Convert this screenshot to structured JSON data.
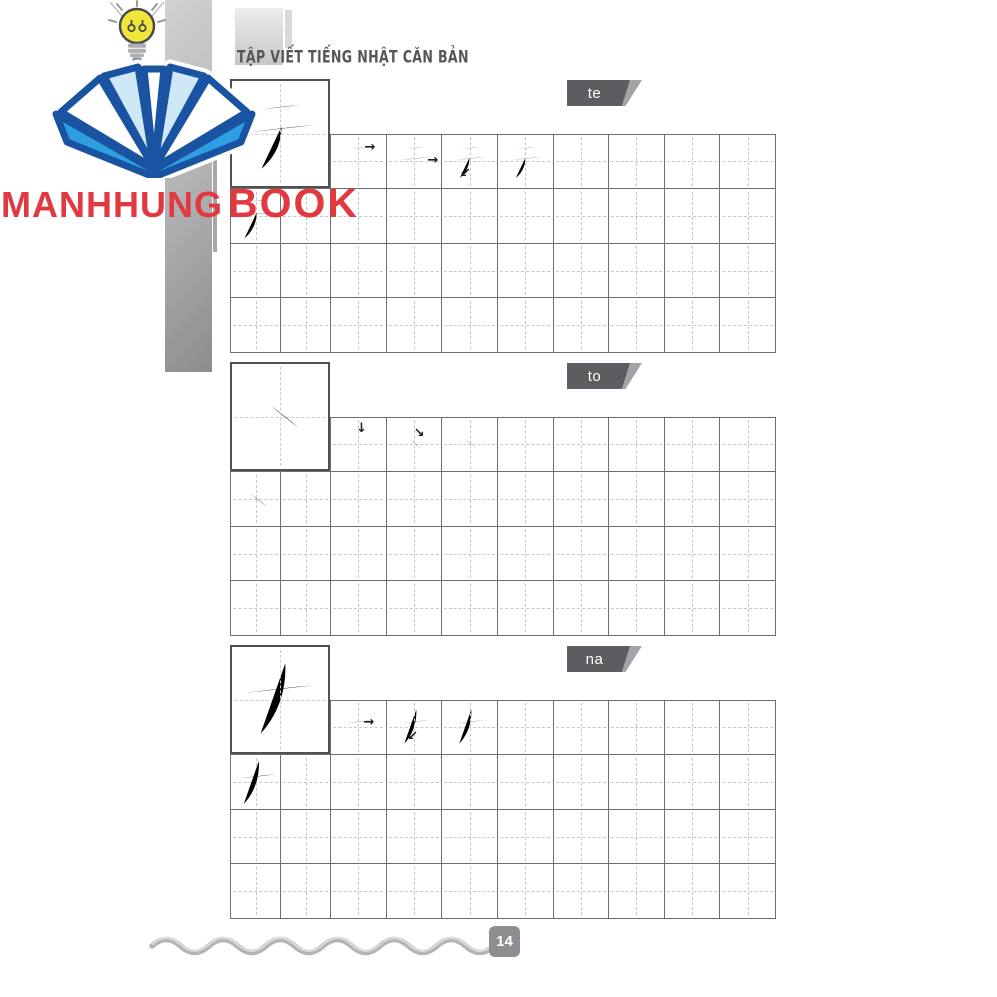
{
  "header": {
    "title": "TẬP VIẾT TIẾNG NHẬT CĂN BẢN"
  },
  "branding": {
    "name_primary": "MANHHUNG",
    "name_secondary": "BOOK",
    "brand_color": "#e23940",
    "logo": "open-book-icon",
    "emblem": "lightbulb-icon"
  },
  "page": {
    "number": "14"
  },
  "sections": [
    {
      "id": "te",
      "label": "te",
      "kana": "テ",
      "stroke_count": 3,
      "arrows": [
        "right",
        "right",
        "down-left"
      ]
    },
    {
      "id": "to",
      "label": "to",
      "kana": "ト",
      "stroke_count": 2,
      "arrows": [
        "down",
        "down-right"
      ]
    },
    {
      "id": "na",
      "label": "na",
      "kana": "ナ",
      "stroke_count": 2,
      "arrows": [
        "right",
        "down-left"
      ]
    }
  ]
}
